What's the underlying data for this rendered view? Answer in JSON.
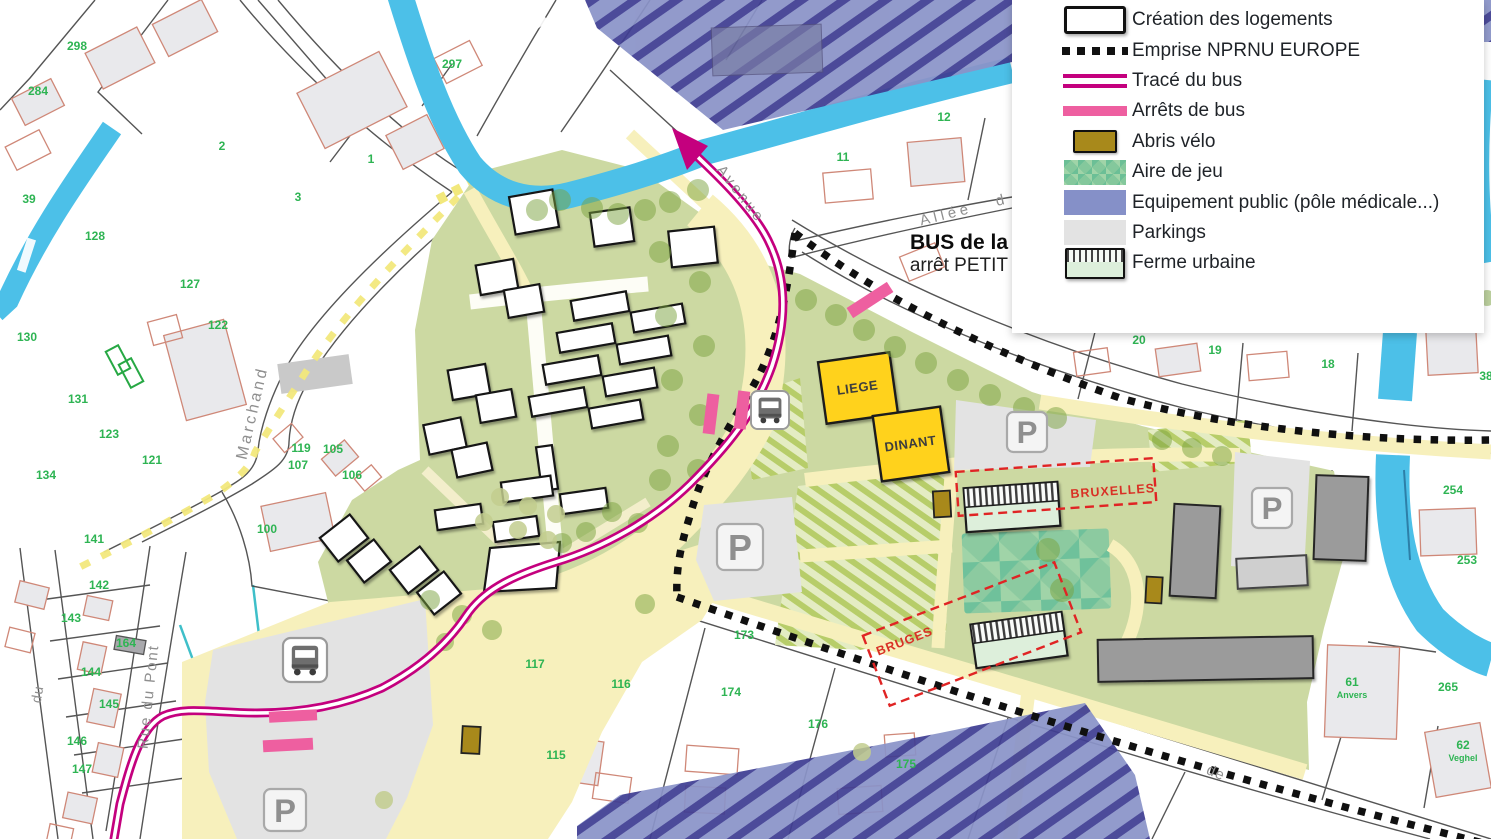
{
  "legend": {
    "items": [
      {
        "label": "Création des logements",
        "swatch": "logements"
      },
      {
        "label": "Emprise NPRNU EUROPE",
        "swatch": "nprnu"
      },
      {
        "label": "Tracé du bus",
        "swatch": "trace-bus"
      },
      {
        "label": "Arrêts de bus",
        "swatch": "arrets-bus"
      },
      {
        "label": "Abris vélo",
        "swatch": "abris-velo"
      },
      {
        "label": "Aire de jeu",
        "swatch": "aire-jeu"
      },
      {
        "label": "Equipement public (pôle médicale...)",
        "swatch": "equipement"
      },
      {
        "label": "Parkings",
        "swatch": "parkings"
      },
      {
        "label": "Ferme urbaine",
        "swatch": "ferme"
      }
    ]
  },
  "map": {
    "annotations": {
      "bus_line": "BUS de la",
      "bus_stop": "arrêt PETIT",
      "liege": "LIEGE",
      "dinant": "DINANT",
      "bruxelles": "BRUXELLES",
      "bruges": "BRUGES",
      "parking_symbol": "P"
    },
    "streets": [
      {
        "text": "Avenue",
        "x": 737,
        "y": 197,
        "r": 52,
        "fs": 15,
        "ls": 3
      },
      {
        "text": "Allée",
        "x": 947,
        "y": 219,
        "r": -14,
        "fs": 15,
        "ls": 4
      },
      {
        "text": "d",
        "x": 1001,
        "y": 205,
        "r": -14,
        "fs": 15,
        "ls": 0
      },
      {
        "text": "Marchand",
        "x": 257,
        "y": 414,
        "r": -77,
        "fs": 16,
        "ls": 3
      },
      {
        "text": "Rue du Pont",
        "x": 153,
        "y": 697,
        "r": -84,
        "fs": 15,
        "ls": 2
      },
      {
        "text": "du",
        "x": 42,
        "y": 695,
        "r": -80,
        "fs": 14,
        "ls": 1
      },
      {
        "text": "de",
        "x": 1214,
        "y": 777,
        "r": 23,
        "fs": 15,
        "ls": 1
      }
    ],
    "parcels": [
      {
        "n": "297",
        "x": 452,
        "y": 68
      },
      {
        "n": "298",
        "x": 77,
        "y": 50
      },
      {
        "n": "284",
        "x": 38,
        "y": 95
      },
      {
        "n": "2",
        "x": 222,
        "y": 150
      },
      {
        "n": "1",
        "x": 371,
        "y": 163
      },
      {
        "n": "3",
        "x": 298,
        "y": 201
      },
      {
        "n": "39",
        "x": 29,
        "y": 203
      },
      {
        "n": "128",
        "x": 95,
        "y": 240
      },
      {
        "n": "127",
        "x": 190,
        "y": 288
      },
      {
        "n": "122",
        "x": 218,
        "y": 329
      },
      {
        "n": "130",
        "x": 27,
        "y": 341
      },
      {
        "n": "131",
        "x": 78,
        "y": 403
      },
      {
        "n": "123",
        "x": 109,
        "y": 438
      },
      {
        "n": "121",
        "x": 152,
        "y": 464
      },
      {
        "n": "134",
        "x": 46,
        "y": 479
      },
      {
        "n": "141",
        "x": 94,
        "y": 543
      },
      {
        "n": "119",
        "x": 301,
        "y": 452
      },
      {
        "n": "105",
        "x": 333,
        "y": 453
      },
      {
        "n": "107",
        "x": 298,
        "y": 469
      },
      {
        "n": "106",
        "x": 352,
        "y": 479
      },
      {
        "n": "100",
        "x": 267,
        "y": 533
      },
      {
        "n": "142",
        "x": 99,
        "y": 589
      },
      {
        "n": "143",
        "x": 71,
        "y": 622
      },
      {
        "n": "164",
        "x": 126,
        "y": 647
      },
      {
        "n": "144",
        "x": 91,
        "y": 676
      },
      {
        "n": "145",
        "x": 109,
        "y": 708
      },
      {
        "n": "146",
        "x": 77,
        "y": 745
      },
      {
        "n": "147",
        "x": 82,
        "y": 773
      },
      {
        "n": "117",
        "x": 535,
        "y": 668
      },
      {
        "n": "116",
        "x": 621,
        "y": 688
      },
      {
        "n": "115",
        "x": 556,
        "y": 759
      },
      {
        "n": "173",
        "x": 744,
        "y": 639
      },
      {
        "n": "174",
        "x": 731,
        "y": 696
      },
      {
        "n": "176",
        "x": 818,
        "y": 728
      },
      {
        "n": "175",
        "x": 906,
        "y": 768
      },
      {
        "n": "11",
        "x": 843,
        "y": 161
      },
      {
        "n": "12",
        "x": 944,
        "y": 121
      },
      {
        "n": "20",
        "x": 1139,
        "y": 344
      },
      {
        "n": "19",
        "x": 1215,
        "y": 354
      },
      {
        "n": "18",
        "x": 1328,
        "y": 368
      },
      {
        "n": "38",
        "x": 1486,
        "y": 380
      },
      {
        "n": "254",
        "x": 1453,
        "y": 494
      },
      {
        "n": "253",
        "x": 1467,
        "y": 564
      },
      {
        "n": "265",
        "x": 1448,
        "y": 691
      },
      {
        "n": "61",
        "x": 1352,
        "y": 686
      },
      {
        "n": "Anvers",
        "x": 1352,
        "y": 698,
        "s": 1
      },
      {
        "n": "62",
        "x": 1463,
        "y": 749
      },
      {
        "n": "Veghel",
        "x": 1463,
        "y": 761,
        "s": 1
      }
    ],
    "trees": [
      [
        592,
        208
      ],
      [
        618,
        214
      ],
      [
        645,
        210
      ],
      [
        670,
        202
      ],
      [
        698,
        190
      ],
      [
        560,
        200
      ],
      [
        537,
        210
      ],
      [
        806,
        300
      ],
      [
        836,
        315
      ],
      [
        864,
        330
      ],
      [
        895,
        347
      ],
      [
        926,
        363
      ],
      [
        958,
        380
      ],
      [
        990,
        395
      ],
      [
        1024,
        408
      ],
      [
        1056,
        418
      ],
      [
        660,
        252
      ],
      [
        700,
        282
      ],
      [
        666,
        316
      ],
      [
        704,
        346
      ],
      [
        672,
        380
      ],
      [
        700,
        415
      ],
      [
        668,
        446
      ],
      [
        698,
        470
      ],
      [
        660,
        480
      ],
      [
        645,
        604,
        10
      ],
      [
        1048,
        550,
        12
      ],
      [
        1062,
        590,
        12
      ],
      [
        1162,
        440,
        10
      ],
      [
        1192,
        448,
        10
      ],
      [
        1222,
        456,
        10
      ],
      [
        430,
        600,
        10
      ],
      [
        462,
        615,
        10
      ],
      [
        492,
        630,
        10
      ],
      [
        445,
        642,
        9
      ],
      [
        612,
        512,
        10
      ],
      [
        638,
        523,
        10
      ],
      [
        586,
        532,
        10
      ],
      [
        562,
        543,
        10
      ],
      [
        500,
        497,
        9,
        2
      ],
      [
        528,
        506,
        9,
        2
      ],
      [
        556,
        514,
        9,
        2
      ],
      [
        518,
        530,
        9,
        2
      ],
      [
        548,
        540,
        9,
        2
      ],
      [
        484,
        522,
        9,
        2
      ],
      [
        384,
        800,
        9,
        2
      ],
      [
        862,
        752,
        9,
        2
      ],
      [
        1487,
        298,
        8
      ]
    ],
    "p_marks": [
      {
        "x": 740,
        "y": 547,
        "s": 46
      },
      {
        "x": 1027,
        "y": 432,
        "s": 40
      },
      {
        "x": 1272,
        "y": 508,
        "s": 40
      },
      {
        "x": 285,
        "y": 810,
        "s": 42
      }
    ],
    "colors": {
      "water": "#4cc0e8",
      "project_green": "#ccd9a2",
      "equip_base": "#8a93c8",
      "equip_stripe": "#3f3d92",
      "hatch_green_stripe": "#b7cd69",
      "play_green": "#8ccaa0",
      "road_yellow": "#f7f0bc",
      "bus_route": "#c4007e",
      "bus_stop": "#ee5fa0",
      "bike_shelter": "#a8891b",
      "farm_fill": "#ddefdb",
      "parking": "#e3e3e3",
      "building_gray": "#9b9b9b",
      "yellow_building": "#ffd21e",
      "label_red": "#d93025",
      "parcel_green": "#2eb453",
      "nprnu_black": "#101010"
    }
  }
}
